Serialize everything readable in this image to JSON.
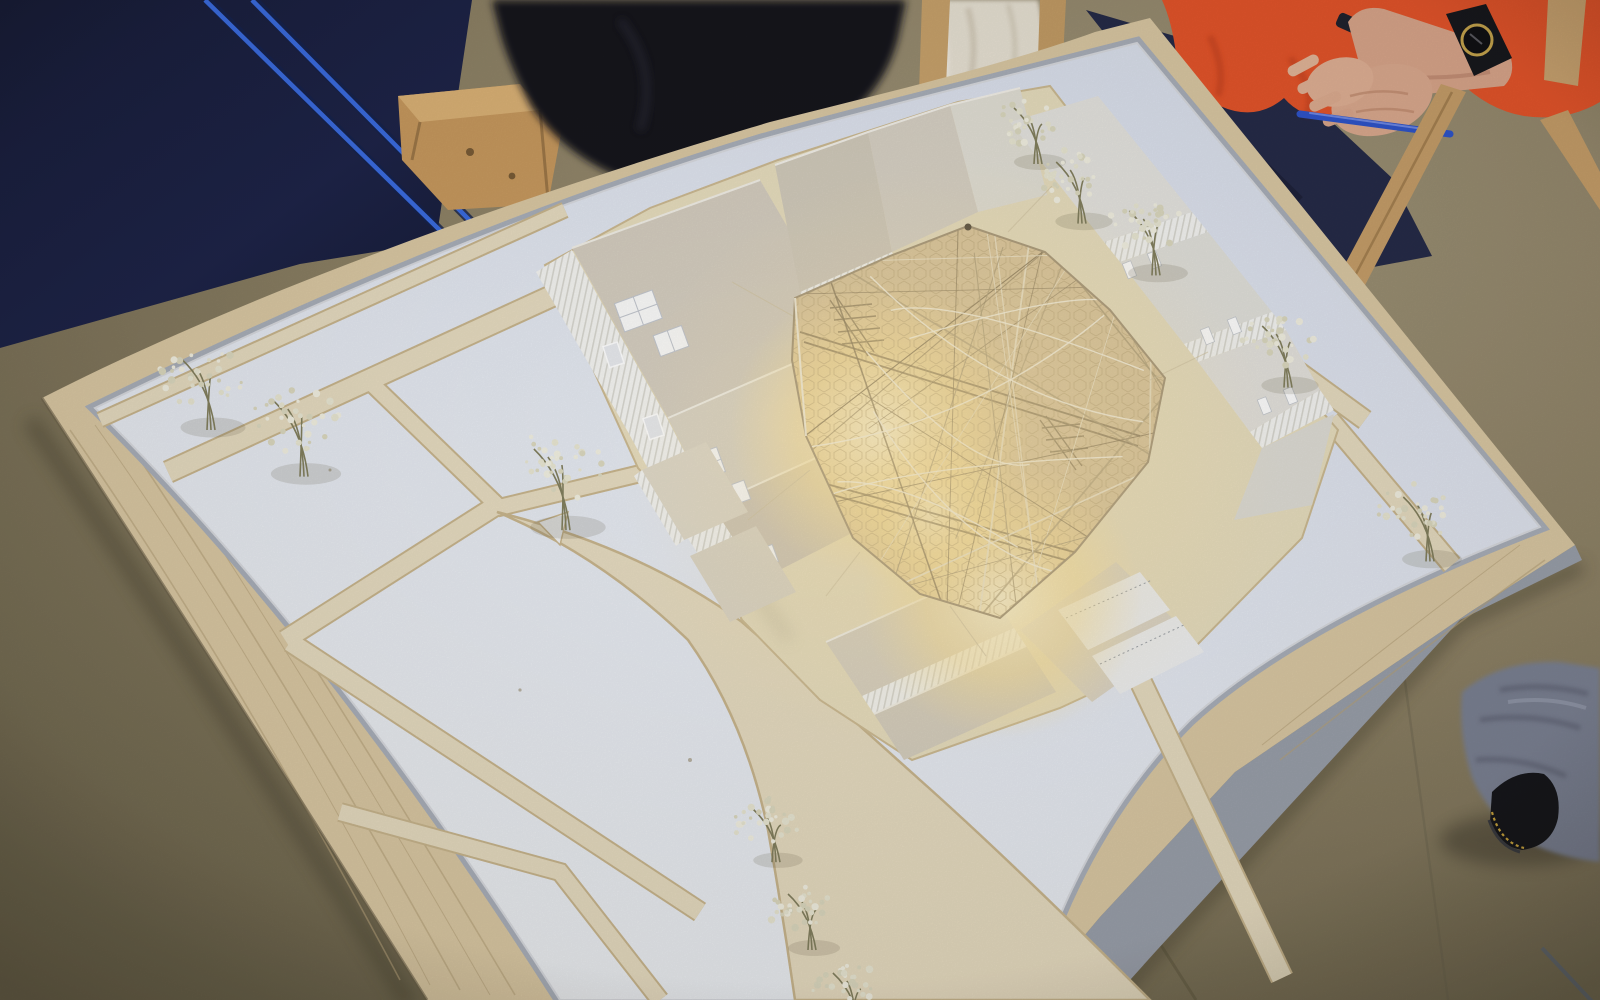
{
  "scene": {
    "description": "Photograph of an architectural scale model on a table: white card city blocks on a balsa board, beige streets, dried-flower trees, central courtyard covered by a glowing golden wire-mesh canopy; navy presentation board with blue cords at top left; person in orange sweater with clasped hands, watch and blue pen at top right; grey trouser leg and black shoe at bottom right.",
    "objects": [
      "floor",
      "presentation-panel",
      "blue-cords",
      "wood-crate",
      "dark-jacket",
      "cream-coat",
      "chair-legs",
      "orange-sweater",
      "navy-trousers",
      "clasped-hands",
      "wristwatch",
      "blue-pen",
      "model-board",
      "model-sheet",
      "streets",
      "plaza",
      "site-ground",
      "buildings",
      "roof-dormers",
      "glowing-canopy",
      "mesh-wires",
      "dried-flower-trees",
      "grey-trouser",
      "black-shoe"
    ]
  },
  "palette": {
    "floor": "#8e8266",
    "floor_dark": "#6f674f",
    "floor_light": "#9d9274",
    "panel_navy": "#1c2244",
    "cord_blue": "#3b6ce0",
    "sheet_white": "#e9ecf2",
    "sheet_cool": "#dde3ee",
    "street_beige": "#e7dcc1",
    "curb": "#c9b68e",
    "apron": "#e8debf",
    "balsa": "#dbc9a4",
    "balsa_grain": "#b7a37c",
    "gray_board": "#9ba1ac",
    "roof_beige": "#d5cec0",
    "wall_white": "#f5f5f2",
    "canopy_gold": "#dcc79e",
    "glow_hot": "#fff6d6",
    "glow_warm": "#ffedb8",
    "mesh_line": "#b7a478",
    "wire_bright": "#efe7cf",
    "wire_dark": "#8f7f60",
    "sweater_orange": "#e6552b",
    "trouser_navy": "#262b48",
    "skin": "#ddab90",
    "watch_black": "#17181d",
    "watch_gold": "#c8a64e",
    "pen_blue": "#2f55cc",
    "chair_wood": "#c79f6a",
    "crate_wood": "#c89a5f",
    "coat_cream": "#e9e3d5",
    "jacket_dark": "#13141b",
    "fabric_gray": "#7c8294",
    "shoe_black": "#16171b",
    "stitch_yellow": "#c9a43e",
    "flower": "#e9e7d3",
    "stem": "#83805f"
  },
  "trees": [
    {
      "x": 205,
      "y": 385,
      "r": 50
    },
    {
      "x": 298,
      "y": 428,
      "r": 54
    },
    {
      "x": 560,
      "y": 478,
      "r": 58
    },
    {
      "x": 1032,
      "y": 128,
      "r": 40
    },
    {
      "x": 1076,
      "y": 184,
      "r": 44
    },
    {
      "x": 1150,
      "y": 234,
      "r": 46
    },
    {
      "x": 1282,
      "y": 348,
      "r": 44
    },
    {
      "x": 1424,
      "y": 520,
      "r": 46
    },
    {
      "x": 770,
      "y": 828,
      "r": 38
    },
    {
      "x": 806,
      "y": 914,
      "r": 40
    },
    {
      "x": 850,
      "y": 992,
      "r": 38
    }
  ],
  "canopy": {
    "wire_count": 28,
    "arc_count": 8,
    "seed": 7,
    "glow_spots": [
      {
        "x": 880,
        "y": 430,
        "r": 150,
        "color": "#fff6d6",
        "opacity": 0.95
      },
      {
        "x": 1002,
        "y": 598,
        "r": 140,
        "color": "#ffedb8",
        "opacity": 0.9
      },
      {
        "x": 930,
        "y": 515,
        "r": 85,
        "color": "#ffe9ae",
        "opacity": 0.6
      }
    ]
  }
}
